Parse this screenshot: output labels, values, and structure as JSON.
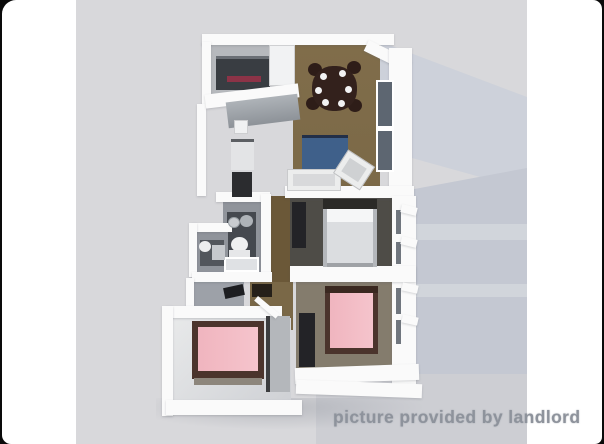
{
  "watermark": {
    "text": "picture provided by landlord"
  },
  "colors": {
    "photo-bg": "#d8d8db",
    "wall-white": "#fafafa",
    "band-upper": "#cdd1da",
    "band-lower": "#c4c8d2",
    "band-streak": "#d4d7dd",
    "band-bottom": "#cdced3",
    "floor-wood": "#7a6847",
    "floor-wood-dark": "#6b5838",
    "floor-kitchen": "#b6b9bd",
    "floor-bed1": "#4e4c47",
    "floor-bed2": "#847c6d",
    "floor-bed3": "#e8e9ea",
    "floor-bath": "#90949b",
    "bath-tile-dark": "#45494f",
    "counter-dark": "#393d42",
    "counter-gray": "#9ba0a5",
    "stove-red": "#8c3347",
    "table-brown": "#33211c",
    "sofa-blue": "#3f608a",
    "sofa-edge": "#222f48",
    "bed-pink": "#f0b5bf",
    "bed-frame-brown": "#4b342c",
    "bed-white": "#dbdde0",
    "headboard-dark": "#2b2a27",
    "closet-dark": "#232327",
    "window-glass": "#5d6671",
    "watermark-gray": "#8e939c"
  }
}
